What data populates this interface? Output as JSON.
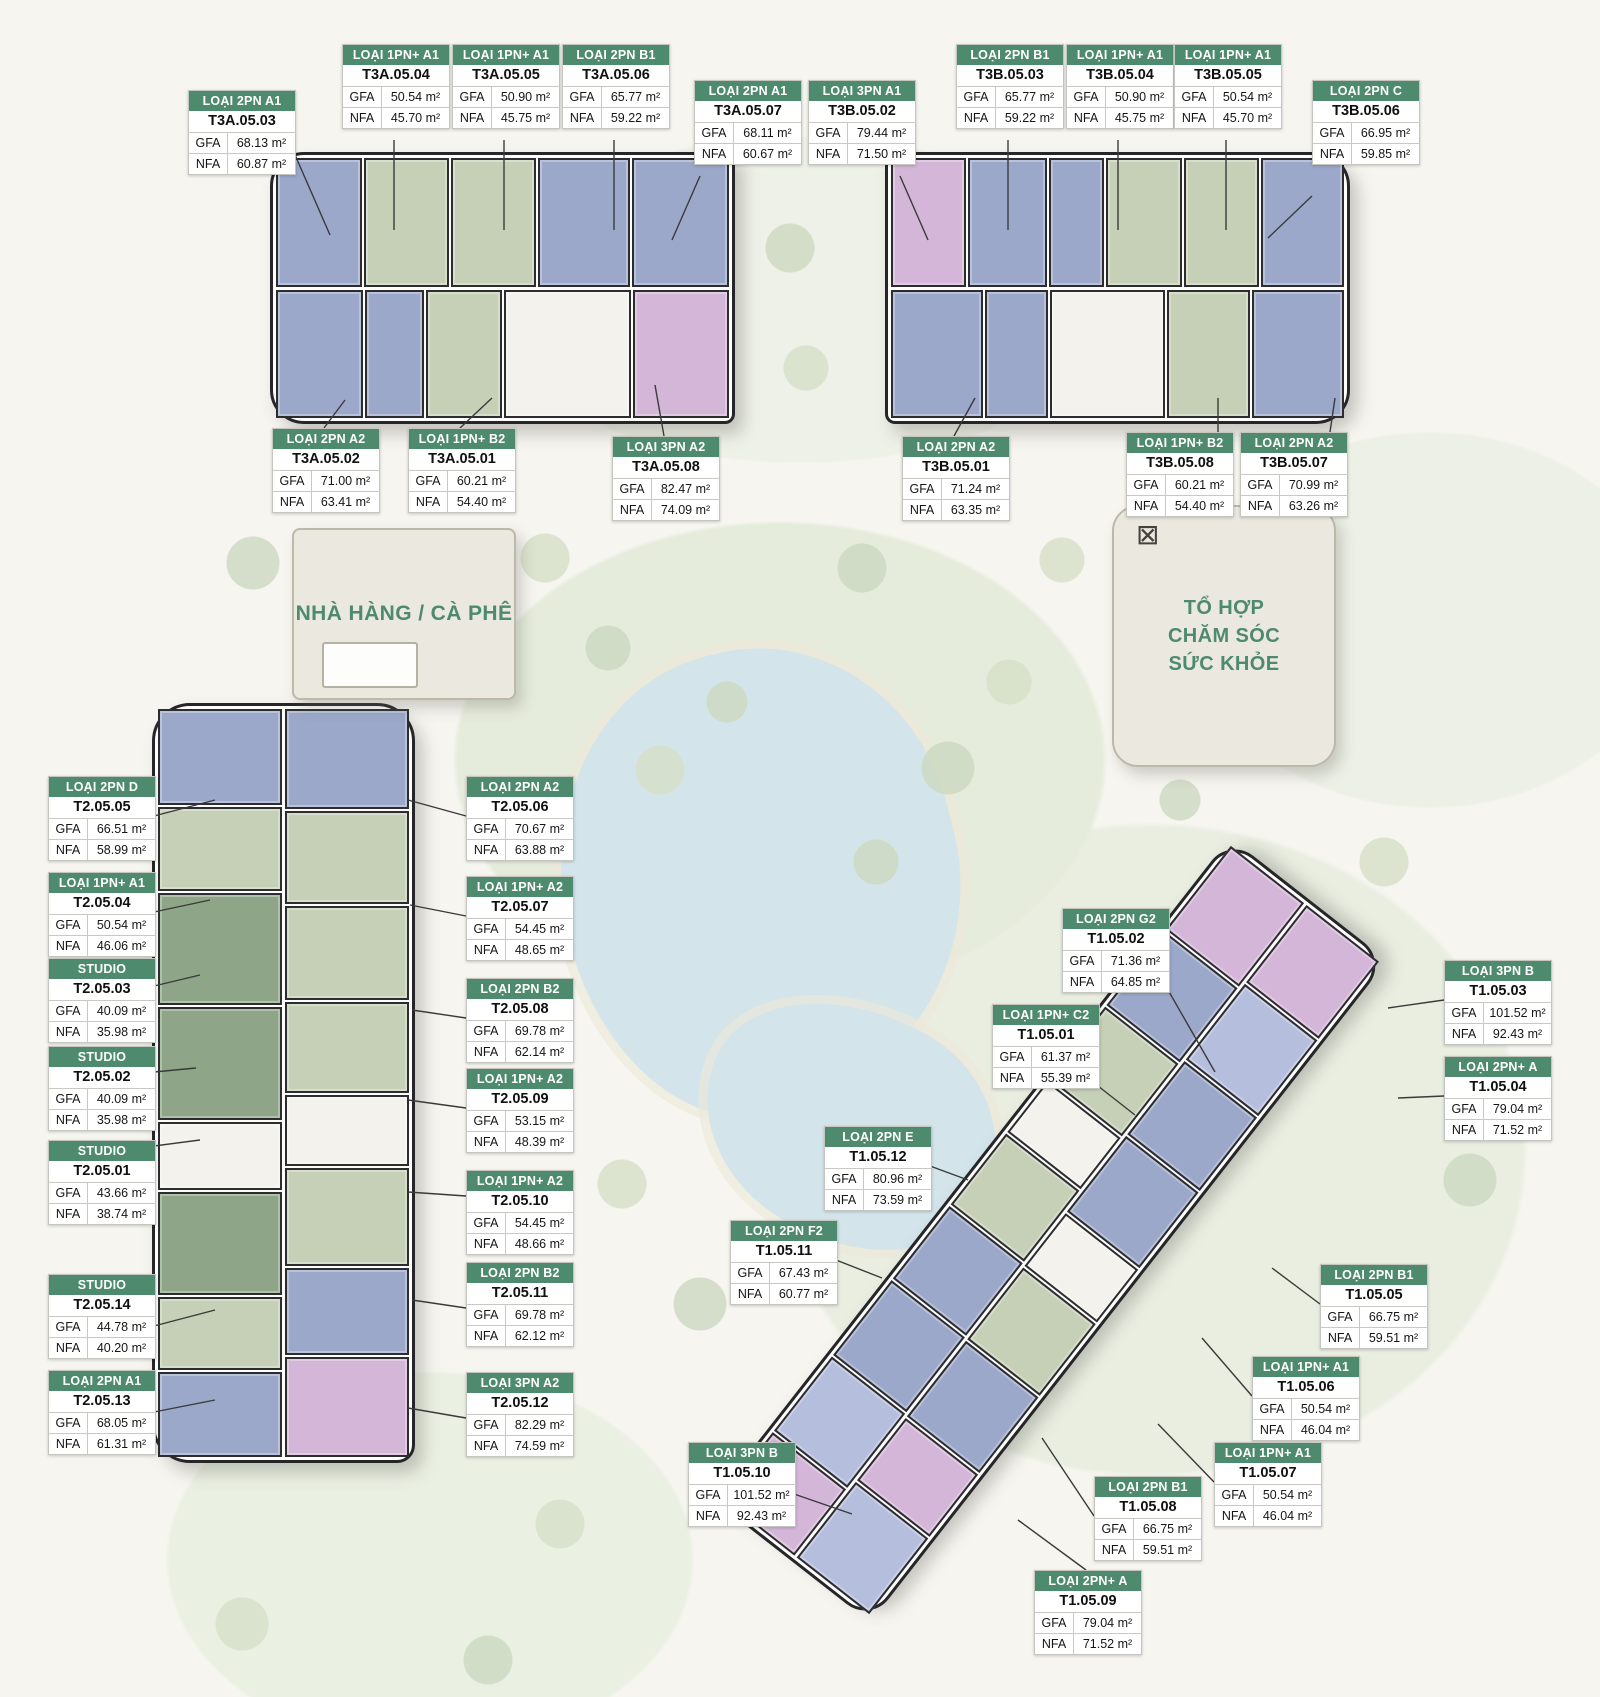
{
  "colors": {
    "header_green": "#4e8a6e",
    "amenity_text_green": "#4e8a6e",
    "units": {
      "blue": "#9ba8c9",
      "green": "#c6d0b6",
      "dkgreen": "#8ea687",
      "pink": "#d4b6d8",
      "lav": "#b6bedd",
      "core": "#f3f2ec"
    }
  },
  "field_labels": {
    "gfa": "GFA",
    "nfa": "NFA"
  },
  "amenities": {
    "restaurant": {
      "label": "NHÀ HÀNG / CÀ PHÊ"
    },
    "health": {
      "label": "TỔ HỢP\nCHĂM SÓC\nSỨC KHỎE"
    }
  },
  "buildings": [
    {
      "name": "tower-t3a",
      "x": 270,
      "y": 152,
      "w": 465,
      "h": 272,
      "radius": "34px 10px 10px 34px",
      "rows": [
        [
          [
            "blue",
            90
          ],
          [
            "green",
            88
          ],
          [
            "green",
            88
          ],
          [
            "blue",
            96
          ],
          [
            "blue",
            102
          ]
        ],
        [
          [
            "blue",
            86
          ],
          [
            "blue",
            58
          ],
          [
            "green",
            74
          ],
          [
            "core",
            128
          ],
          [
            "pink",
            96
          ]
        ]
      ]
    },
    {
      "name": "tower-t3b",
      "x": 885,
      "y": 152,
      "w": 465,
      "h": 272,
      "radius": "10px 34px 34px 10px",
      "rows": [
        [
          [
            "pink",
            86
          ],
          [
            "blue",
            92
          ],
          [
            "blue",
            62
          ],
          [
            "green",
            88
          ],
          [
            "green",
            86
          ],
          [
            "blue",
            96
          ]
        ],
        [
          [
            "blue",
            96
          ],
          [
            "blue",
            64
          ],
          [
            "core",
            120
          ],
          [
            "green",
            86
          ],
          [
            "blue",
            96
          ]
        ]
      ]
    },
    {
      "name": "tower-t2",
      "x": 152,
      "y": 703,
      "w": 263,
      "h": 760,
      "radius": "38px 38px 18px 38px",
      "vertical": true,
      "rows": [
        [
          [
            "blue",
            100
          ],
          [
            "green",
            88
          ],
          [
            "dkgreen",
            118
          ],
          [
            "dkgreen",
            118
          ],
          [
            "core",
            70
          ],
          [
            "dkgreen",
            108
          ],
          [
            "green",
            76
          ],
          [
            "blue",
            88
          ]
        ],
        [
          [
            "blue",
            100
          ],
          [
            "green",
            92
          ],
          [
            "green",
            94
          ],
          [
            "green",
            90
          ],
          [
            "core",
            70
          ],
          [
            "green",
            98
          ],
          [
            "blue",
            86
          ],
          [
            "pink",
            100
          ]
        ]
      ]
    },
    {
      "name": "tower-t1",
      "x": 630,
      "y": 1130,
      "w": 840,
      "h": 200,
      "radius": "30px",
      "rotate": -52,
      "rows": [
        [
          [
            "pink",
            78
          ],
          [
            "lav",
            88
          ],
          [
            "blue",
            90
          ],
          [
            "blue",
            86
          ],
          [
            "green",
            84
          ],
          [
            "core",
            60
          ],
          [
            "green",
            86
          ],
          [
            "blue",
            88
          ],
          [
            "pink",
            100
          ]
        ],
        [
          [
            "lav",
            88
          ],
          [
            "pink",
            72
          ],
          [
            "blue",
            88
          ],
          [
            "green",
            84
          ],
          [
            "core",
            60
          ],
          [
            "blue",
            88
          ],
          [
            "blue",
            86
          ],
          [
            "lav",
            88
          ],
          [
            "pink",
            90
          ]
        ]
      ]
    }
  ],
  "unit_labels": [
    {
      "code": "T3A.05.03",
      "type": "LOẠI 2PN A1",
      "gfa": "68.13 m²",
      "nfa": "60.87 m²",
      "x": 188,
      "y": 90,
      "leader": [
        292,
        148,
        330,
        235
      ]
    },
    {
      "code": "T3A.05.04",
      "type": "LOẠI 1PN+ A1",
      "gfa": "50.54 m²",
      "nfa": "45.70 m²",
      "x": 342,
      "y": 44,
      "leader": [
        394,
        140,
        394,
        230
      ]
    },
    {
      "code": "T3A.05.05",
      "type": "LOẠI 1PN+ A1",
      "gfa": "50.90 m²",
      "nfa": "45.75 m²",
      "x": 452,
      "y": 44,
      "leader": [
        504,
        140,
        504,
        230
      ]
    },
    {
      "code": "T3A.05.06",
      "type": "LOẠI 2PN B1",
      "gfa": "65.77 m²",
      "nfa": "59.22 m²",
      "x": 562,
      "y": 44,
      "leader": [
        614,
        140,
        614,
        230
      ]
    },
    {
      "code": "T3A.05.07",
      "type": "LOẠI 2PN A1",
      "gfa": "68.11 m²",
      "nfa": "60.67 m²",
      "x": 694,
      "y": 80,
      "leader": [
        700,
        176,
        672,
        240
      ]
    },
    {
      "code": "T3A.05.02",
      "type": "LOẠI 2PN A2",
      "gfa": "71.00 m²",
      "nfa": "63.41 m²",
      "x": 272,
      "y": 428,
      "leader": [
        324,
        428,
        345,
        400
      ]
    },
    {
      "code": "T3A.05.01",
      "type": "LOẠI 1PN+ B2",
      "gfa": "60.21 m²",
      "nfa": "54.40 m²",
      "x": 408,
      "y": 428,
      "leader": [
        460,
        428,
        492,
        398
      ]
    },
    {
      "code": "T3A.05.08",
      "type": "LOẠI 3PN A2",
      "gfa": "82.47 m²",
      "nfa": "74.09 m²",
      "x": 612,
      "y": 436,
      "leader": [
        664,
        436,
        655,
        385
      ]
    },
    {
      "code": "T3B.05.02",
      "type": "LOẠI 3PN A1",
      "gfa": "79.44 m²",
      "nfa": "71.50 m²",
      "x": 808,
      "y": 80,
      "leader": [
        900,
        176,
        928,
        240
      ]
    },
    {
      "code": "T3B.05.03",
      "type": "LOẠI 2PN B1",
      "gfa": "65.77 m²",
      "nfa": "59.22 m²",
      "x": 956,
      "y": 44,
      "leader": [
        1008,
        140,
        1008,
        230
      ]
    },
    {
      "code": "T3B.05.04",
      "type": "LOẠI 1PN+ A1",
      "gfa": "50.90 m²",
      "nfa": "45.75 m²",
      "x": 1066,
      "y": 44,
      "leader": [
        1118,
        140,
        1118,
        230
      ]
    },
    {
      "code": "T3B.05.05",
      "type": "LOẠI 1PN+ A1",
      "gfa": "50.54 m²",
      "nfa": "45.70 m²",
      "x": 1174,
      "y": 44,
      "leader": [
        1226,
        140,
        1226,
        230
      ]
    },
    {
      "code": "T3B.05.06",
      "type": "LOẠI 2PN C",
      "gfa": "66.95 m²",
      "nfa": "59.85 m²",
      "x": 1312,
      "y": 80,
      "leader": [
        1312,
        196,
        1268,
        238
      ]
    },
    {
      "code": "T3B.05.01",
      "type": "LOẠI 2PN A2",
      "gfa": "71.24 m²",
      "nfa": "63.35 m²",
      "x": 902,
      "y": 436,
      "leader": [
        954,
        436,
        975,
        398
      ]
    },
    {
      "code": "T3B.05.08",
      "type": "LOẠI 1PN+ B2",
      "gfa": "60.21 m²",
      "nfa": "54.40 m²",
      "x": 1126,
      "y": 432,
      "leader": [
        1218,
        432,
        1218,
        398
      ]
    },
    {
      "code": "T3B.05.07",
      "type": "LOẠI 2PN A2",
      "gfa": "70.99 m²",
      "nfa": "63.26 m²",
      "x": 1240,
      "y": 432,
      "leader": [
        1330,
        432,
        1335,
        398
      ]
    },
    {
      "code": "T2.05.05",
      "type": "LOẠI 2PN D",
      "gfa": "66.51 m²",
      "nfa": "58.99 m²",
      "x": 48,
      "y": 776,
      "leader": [
        154,
        816,
        215,
        800
      ]
    },
    {
      "code": "T2.05.04",
      "type": "LOẠI 1PN+ A1",
      "gfa": "50.54 m²",
      "nfa": "46.06 m²",
      "x": 48,
      "y": 872,
      "leader": [
        154,
        912,
        210,
        900
      ]
    },
    {
      "code": "T2.05.03",
      "type": "STUDIO",
      "gfa": "40.09 m²",
      "nfa": "35.98 m²",
      "x": 48,
      "y": 958,
      "leader": [
        154,
        986,
        200,
        975
      ]
    },
    {
      "code": "T2.05.02",
      "type": "STUDIO",
      "gfa": "40.09 m²",
      "nfa": "35.98 m²",
      "x": 48,
      "y": 1046,
      "leader": [
        154,
        1072,
        196,
        1068
      ]
    },
    {
      "code": "T2.05.01",
      "type": "STUDIO",
      "gfa": "43.66 m²",
      "nfa": "38.74 m²",
      "x": 48,
      "y": 1140,
      "leader": [
        154,
        1146,
        200,
        1140
      ]
    },
    {
      "code": "T2.05.14",
      "type": "STUDIO",
      "gfa": "44.78 m²",
      "nfa": "40.20 m²",
      "x": 48,
      "y": 1274,
      "leader": [
        154,
        1326,
        215,
        1310
      ]
    },
    {
      "code": "T2.05.13",
      "type": "LOẠI 2PN A1",
      "gfa": "68.05 m²",
      "nfa": "61.31 m²",
      "x": 48,
      "y": 1370,
      "leader": [
        154,
        1412,
        215,
        1400
      ]
    },
    {
      "code": "T2.05.06",
      "type": "LOẠI 2PN A2",
      "gfa": "70.67 m²",
      "nfa": "63.88 m²",
      "x": 466,
      "y": 776,
      "leader": [
        466,
        816,
        408,
        800
      ]
    },
    {
      "code": "T2.05.07",
      "type": "LOẠI 1PN+ A2",
      "gfa": "54.45 m²",
      "nfa": "48.65 m²",
      "x": 466,
      "y": 876,
      "leader": [
        466,
        916,
        410,
        905
      ]
    },
    {
      "code": "T2.05.08",
      "type": "LOẠI 2PN B2",
      "gfa": "69.78 m²",
      "nfa": "62.14 m²",
      "x": 466,
      "y": 978,
      "leader": [
        466,
        1018,
        412,
        1010
      ]
    },
    {
      "code": "T2.05.09",
      "type": "LOẠI 1PN+ A2",
      "gfa": "53.15 m²",
      "nfa": "48.39 m²",
      "x": 466,
      "y": 1068,
      "leader": [
        466,
        1108,
        408,
        1100
      ]
    },
    {
      "code": "T2.05.10",
      "type": "LOẠI 1PN+ A2",
      "gfa": "54.45 m²",
      "nfa": "48.66 m²",
      "x": 466,
      "y": 1170,
      "leader": [
        466,
        1196,
        408,
        1192
      ]
    },
    {
      "code": "T2.05.11",
      "type": "LOẠI 2PN B2",
      "gfa": "69.78 m²",
      "nfa": "62.12 m²",
      "x": 466,
      "y": 1262,
      "leader": [
        466,
        1308,
        412,
        1300
      ]
    },
    {
      "code": "T2.05.12",
      "type": "LOẠI 3PN A2",
      "gfa": "82.29 m²",
      "nfa": "74.59 m²",
      "x": 466,
      "y": 1372,
      "leader": [
        466,
        1418,
        408,
        1408
      ]
    },
    {
      "code": "T1.05.02",
      "type": "LOẠI 2PN G2",
      "gfa": "71.36 m²",
      "nfa": "64.85 m²",
      "x": 1062,
      "y": 908,
      "leader": [
        1168,
        990,
        1215,
        1072
      ]
    },
    {
      "code": "T1.05.01",
      "type": "LOẠI 1PN+ C2",
      "gfa": "61.37 m²",
      "nfa": "55.39 m²",
      "x": 992,
      "y": 1004,
      "leader": [
        1098,
        1086,
        1135,
        1115
      ]
    },
    {
      "code": "T1.05.03",
      "type": "LOẠI 3PN B",
      "gfa": "101.52 m²",
      "nfa": "92.43 m²",
      "x": 1444,
      "y": 960,
      "leader": [
        1444,
        1000,
        1388,
        1008
      ]
    },
    {
      "code": "T1.05.04",
      "type": "LOẠI 2PN+ A",
      "gfa": "79.04 m²",
      "nfa": "71.52 m²",
      "x": 1444,
      "y": 1056,
      "leader": [
        1444,
        1096,
        1398,
        1098
      ]
    },
    {
      "code": "T1.05.12",
      "type": "LOẠI 2PN E",
      "gfa": "80.96 m²",
      "nfa": "73.59 m²",
      "x": 824,
      "y": 1126,
      "leader": [
        930,
        1166,
        968,
        1180
      ]
    },
    {
      "code": "T1.05.11",
      "type": "LOẠI 2PN F2",
      "gfa": "67.43 m²",
      "nfa": "60.77 m²",
      "x": 730,
      "y": 1220,
      "leader": [
        836,
        1260,
        882,
        1278
      ]
    },
    {
      "code": "T1.05.05",
      "type": "LOẠI 2PN B1",
      "gfa": "66.75 m²",
      "nfa": "59.51 m²",
      "x": 1320,
      "y": 1264,
      "leader": [
        1320,
        1304,
        1272,
        1268
      ]
    },
    {
      "code": "T1.05.06",
      "type": "LOẠI 1PN+ A1",
      "gfa": "50.54 m²",
      "nfa": "46.04 m²",
      "x": 1252,
      "y": 1356,
      "leader": [
        1252,
        1396,
        1202,
        1338
      ]
    },
    {
      "code": "T1.05.07",
      "type": "LOẠI 1PN+ A1",
      "gfa": "50.54 m²",
      "nfa": "46.04 m²",
      "x": 1214,
      "y": 1442,
      "leader": [
        1214,
        1482,
        1158,
        1424
      ]
    },
    {
      "code": "T1.05.08",
      "type": "LOẠI 2PN B1",
      "gfa": "66.75 m²",
      "nfa": "59.51 m²",
      "x": 1094,
      "y": 1476,
      "leader": [
        1094,
        1516,
        1042,
        1438
      ]
    },
    {
      "code": "T1.05.09",
      "type": "LOẠI 2PN+ A",
      "gfa": "79.04 m²",
      "nfa": "71.52 m²",
      "x": 1034,
      "y": 1570,
      "leader": [
        1086,
        1570,
        1018,
        1520
      ]
    },
    {
      "code": "T1.05.10",
      "type": "LOẠI 3PN B",
      "gfa": "101.52 m²",
      "nfa": "92.43 m²",
      "x": 688,
      "y": 1442,
      "leader": [
        794,
        1494,
        852,
        1514
      ]
    }
  ]
}
